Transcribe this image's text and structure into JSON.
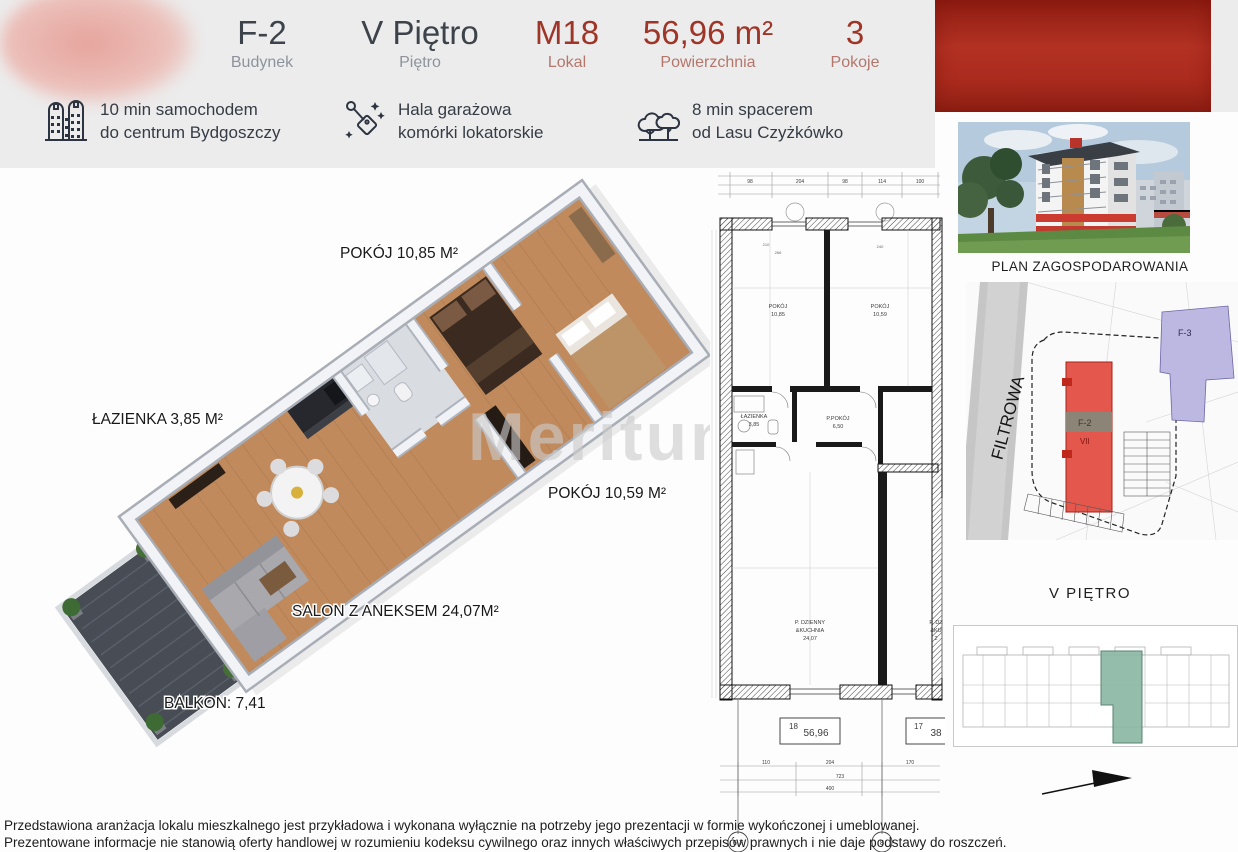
{
  "header": {
    "stats": [
      {
        "value": "F-2",
        "label": "Budynek"
      },
      {
        "value": "V Piętro",
        "label": "Piętro"
      },
      {
        "value": "M18",
        "label": "Lokal"
      },
      {
        "value": "56,96 m²",
        "label": "Powierzchnia"
      },
      {
        "value": "3",
        "label": "Pokoje"
      }
    ]
  },
  "features": [
    {
      "icon": "buildings-icon",
      "line1": "10 min samochodem",
      "line2": "do centrum Bydgoszczy"
    },
    {
      "icon": "garage-tag-icon",
      "line1": "Hala garażowa",
      "line2": "komórki lokatorskie"
    },
    {
      "icon": "trees-icon",
      "line1": "8 min spacerem",
      "line2": "od Lasu Czyżkówko"
    }
  ],
  "plan3d": {
    "watermark": "Meritum",
    "labels": {
      "room1": "POKÓJ 10,85 M²",
      "bath": "ŁAZIENKA 3,85 M²",
      "room2": "POKÓJ 10,59 M²",
      "salon": "SALON Z ANEKSEM 24,07M²",
      "balcony": "BALKON: 7,41"
    }
  },
  "techplan": {
    "rooms": {
      "room1_name": "POKÓJ",
      "room1_area": "10,85",
      "room2_name": "POKÓJ",
      "room2_area": "10,59",
      "bath_name": "ŁAZIENKA",
      "bath_area": "3,85",
      "hall_name": "P.POKÓJ",
      "hall_area": "6,50",
      "salon_line1": "P. DZIENNY",
      "salon_line2": "&KUCHNIA",
      "salon_area": "24,07",
      "neighbor_line1": "P. DZ",
      "neighbor_line2": "&KU",
      "neighbor_area": "2"
    },
    "units": [
      {
        "no": "18",
        "area": "56,96"
      },
      {
        "no": "17",
        "area": "38"
      }
    ],
    "grid_bubbles": [
      "6,7",
      "8"
    ],
    "dims_top": [
      "98",
      "204",
      "98",
      "114",
      "100"
    ],
    "dims_mid": [
      "210",
      "266",
      "240"
    ],
    "dims_bottom": [
      "110",
      "204",
      "170",
      "723",
      "400"
    ]
  },
  "sidebar": {
    "site_plan_title": "PLAN ZAGOSPODAROWANIA",
    "street": "FILTROWA",
    "f2_label": "F-2",
    "f2_floors": "VII",
    "f3_label": "F-3",
    "floor_title": "V PIĘTRO"
  },
  "disclaimer": {
    "line1": "Przedstawiona aranżacja lokalu mieszkalnego jest przykładowa i wykonana wyłącznie na potrzeby jego prezentacji w formie wykończonej i umeblowanej.",
    "line2": "Prezentowane informacje nie stanowią oferty handlowej w rozumieniu kodeksu cywilnego oraz innych właściwych przepisów prawnych i nie daje podstawy do roszczeń."
  },
  "colors": {
    "header_band": "#ececec",
    "red_box": "#a8241a",
    "accent_red": "#9e3527",
    "muted_red": "#b5766c",
    "text_dark": "#3d434b",
    "text_muted": "#8d939c",
    "teal_highlight": "#8cb8a4",
    "site_red": "#e4574d",
    "site_purple": "#bcb8e2",
    "wood": "#c18a5c"
  }
}
